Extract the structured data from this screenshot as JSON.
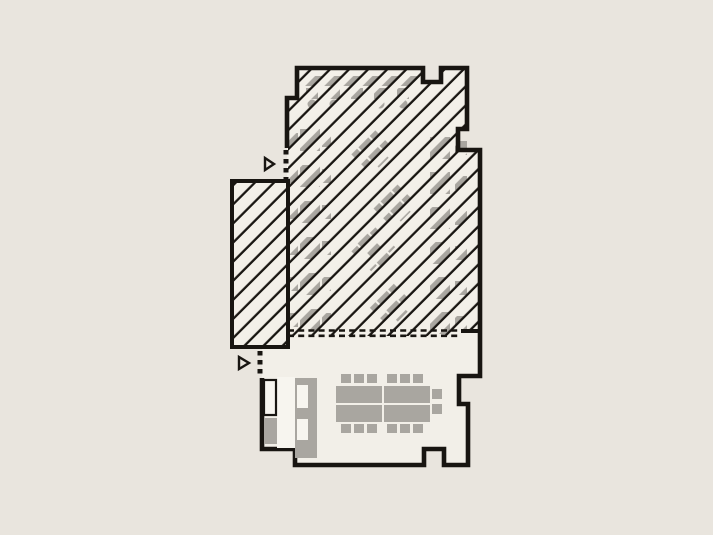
{
  "canvas": {
    "width": 713,
    "height": 535
  },
  "colors": {
    "background": "#e9e5de",
    "floor": "#f2efe8",
    "wall": "#181511",
    "furniture_gray": "#a9a6a0",
    "furniture_light": "#f7f5ef",
    "hatch_band": "#f3f0e9",
    "hatch_line": "#181511"
  },
  "plan": {
    "interior_fill_points": "297,68 423,68 423,82 441,82 441,68 467,68 467,129 458,129 458,150 480,150 480,376 459,376 459,404 468,404 468,465 444,465 444,449 424,449 424,465 295,465 295,449 262,449 262,347 232,347 232,181 287,181 287,98 297,98",
    "wall_path": "M 287,148 L 287,98 L 297,98 L 297,68 L 423,68 L 423,82 L 441,82 L 441,68 L 467,68 L 467,129 L 458,129 L 458,150 L 480,150 L 480,376 L 459,376 L 459,404 L 468,404 L 468,465 L 444,465 L 444,449 L 424,449 L 424,465 L 295,465 L 295,449 L 262,449 L 262,378",
    "wall_width": 4.6,
    "stub_wall_path": "M 461,331 L 480,331",
    "stub_wall_width": 4,
    "annex": {
      "x": 232,
      "y": 181,
      "width": 56,
      "height": 166,
      "stroke_width": 4
    },
    "hatch_region_points": "297,68 423,68 423,82 441,82 441,68 467,68 467,129 458,129 458,150 480,150 480,331 461,331 461,336 288,336 288,98 297,98",
    "hatch_pattern": {
      "period": 13.5,
      "band": 6.6,
      "gap": 4.6,
      "line": 2.3,
      "angle": -45,
      "tile_w": 20
    },
    "open_boundary": {
      "x1": 288,
      "x2": 461,
      "y_top": 330.5,
      "y_bottom": 335.8,
      "dash": "6 4.2",
      "width": 2.6
    },
    "entrances": [
      {
        "name": "upper-entrance",
        "dots": {
          "x": 286,
          "y1": 150,
          "y2": 179
        },
        "triangle": "265,158 265,170 274,164"
      },
      {
        "name": "lower-entrance",
        "dots": {
          "x": 260,
          "y1": 351,
          "y2": 377
        },
        "triangle": "239,357 239,369 249,363"
      }
    ],
    "dot_width": 5,
    "dot_dash": "4.5 4.5",
    "triangle_stroke": 2.4
  },
  "furniture": {
    "hatched_zone": {
      "top_row": {
        "bar": {
          "x": 303,
          "y": 76,
          "w": 114,
          "h": 10
        },
        "chairs_y": 88,
        "chair_w": 12,
        "chair_h": 11,
        "chair_xs": [
          306,
          328,
          351,
          374,
          397
        ],
        "stools_cy": 104,
        "stool_r": 4.5,
        "stool_cxs": [
          312,
          334,
          357,
          380,
          403
        ]
      },
      "left_column": {
        "centers_y": [
          140,
          176,
          212,
          248,
          284,
          320
        ],
        "table": {
          "x": 300,
          "w": 20,
          "h": 22
        },
        "chair_left_x": 289,
        "chair_right_x": 322,
        "chair_w": 9,
        "chair_h": 14
      },
      "diagonal_groups": {
        "centers": [
          [
            371,
            150
          ],
          [
            393,
            204
          ],
          [
            374,
            250
          ],
          [
            390,
            304
          ]
        ],
        "rotation": 45,
        "table": {
          "x": -18,
          "y": -7,
          "w": 36,
          "h": 14
        },
        "chairs": [
          [
            -15,
            -17,
            10,
            8
          ],
          [
            3,
            -17,
            10,
            8
          ],
          [
            -15,
            9,
            10,
            8
          ],
          [
            3,
            9,
            10,
            8
          ]
        ]
      },
      "right_column": {
        "centers_y": [
          148,
          183,
          218,
          253,
          288,
          323
        ],
        "table": {
          "x": 430,
          "w": 20,
          "h": 22
        },
        "chair_x": 455,
        "chair_w": 12,
        "chair_h": 14
      }
    },
    "meeting_room": {
      "tables": [
        [
          336,
          386,
          46,
          17
        ],
        [
          336,
          405,
          46,
          17
        ],
        [
          384,
          386,
          46,
          17
        ],
        [
          384,
          405,
          46,
          17
        ]
      ],
      "chairs_top": {
        "y": 374,
        "w": 10,
        "h": 9,
        "xs": [
          341,
          354,
          367,
          387,
          400,
          413
        ]
      },
      "chairs_bottom": {
        "y": 424,
        "w": 10,
        "h": 9,
        "xs": [
          341,
          354,
          367,
          387,
          400,
          413
        ]
      },
      "chairs_right": [
        [
          432,
          389,
          10,
          10
        ],
        [
          432,
          404,
          10,
          10
        ]
      ],
      "sideboard": {
        "outlined_cabinet": [
          264,
          380,
          12,
          35
        ],
        "outlined_cabinet_stroke": 2.2,
        "gray_box": [
          264,
          418,
          13,
          26
        ],
        "light_panel": [
          277,
          377,
          18,
          71
        ],
        "tall_cabinet": [
          295,
          378,
          22,
          80
        ],
        "cabinet_cutouts": [
          [
            297,
            385,
            11,
            23
          ],
          [
            297,
            419,
            11,
            21
          ]
        ]
      }
    }
  }
}
